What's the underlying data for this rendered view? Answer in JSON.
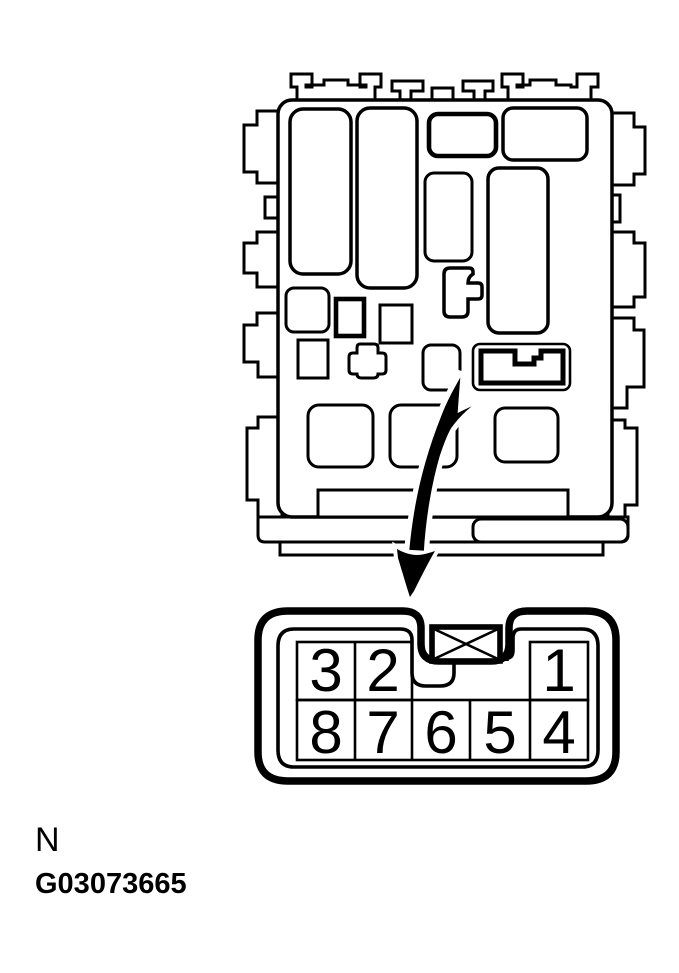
{
  "figure": {
    "label": "N",
    "code": "G03073665"
  },
  "colors": {
    "line": "#000000",
    "background": "#ffffff"
  },
  "fuse_box": {
    "description": "fuse-relay-box-outline-with-highlighted-relay"
  },
  "connector": {
    "description": "8-pin-connector-face-view",
    "top_row": [
      "3",
      "2",
      "1"
    ],
    "bottom_row": [
      "8",
      "7",
      "6",
      "5",
      "4"
    ]
  }
}
